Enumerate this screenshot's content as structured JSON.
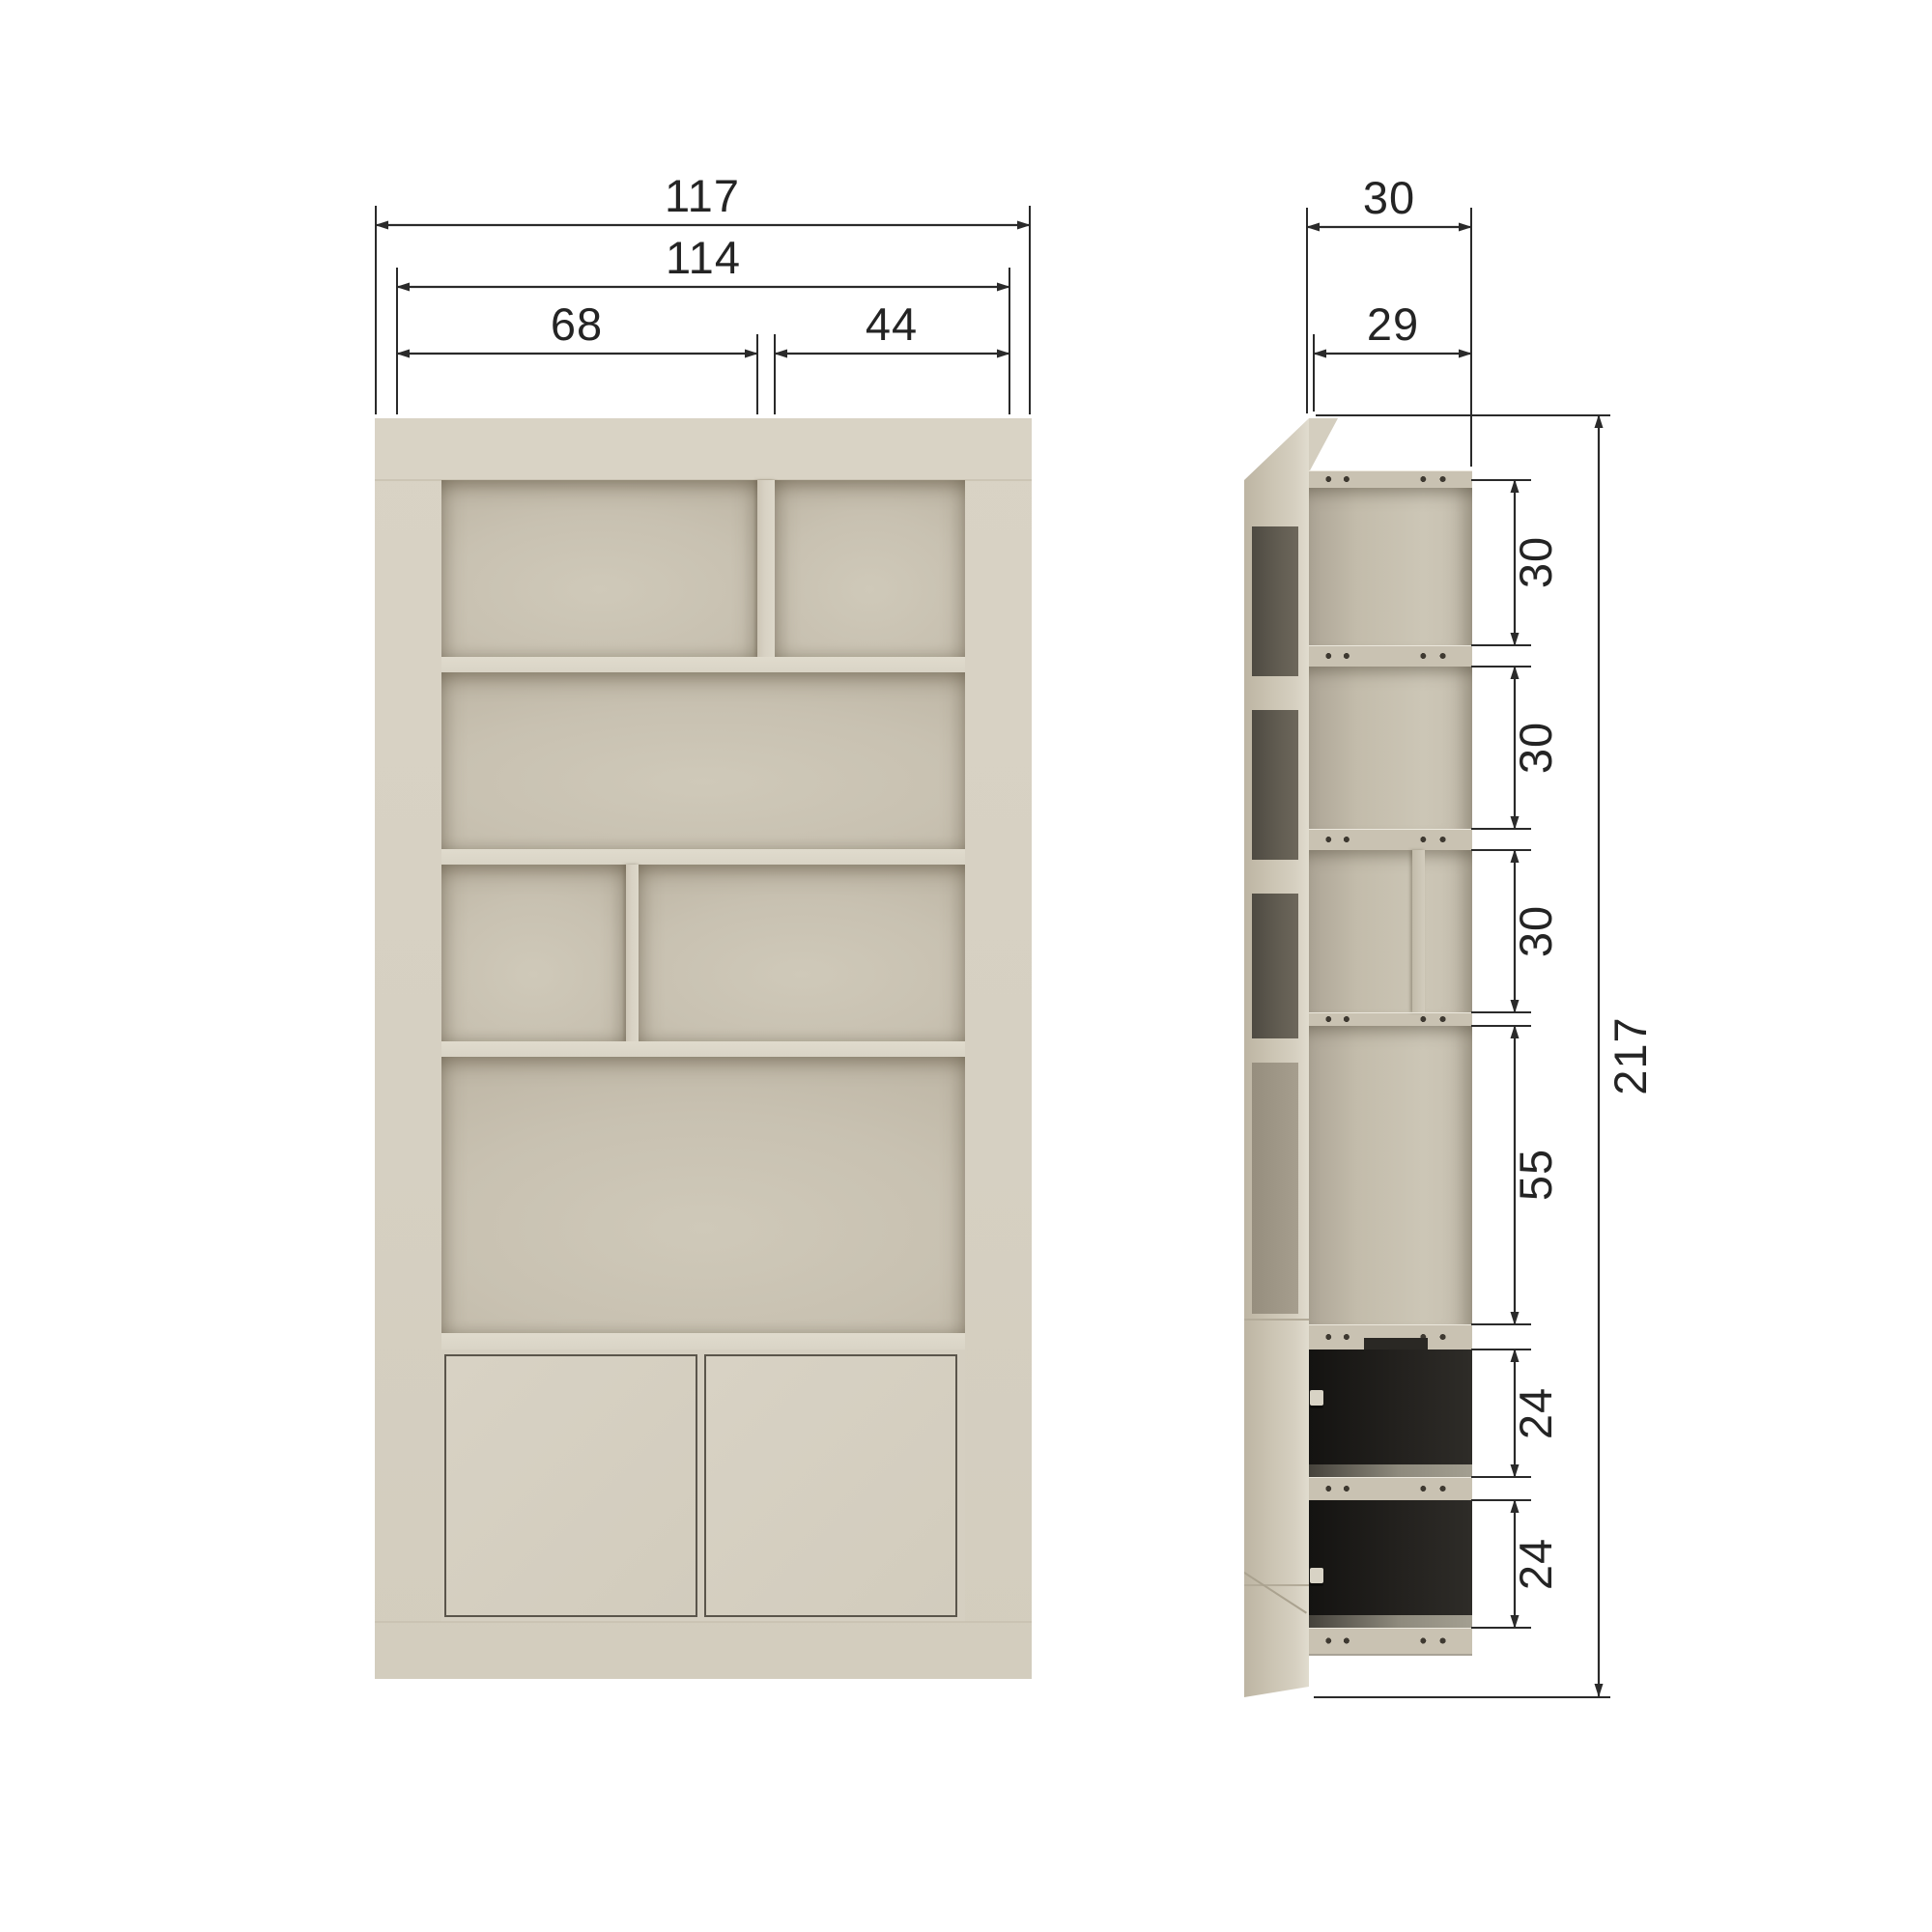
{
  "diagram": {
    "kind": "cabinet dimension drawing, front and side elevation",
    "views": {
      "front": {
        "dims": {
          "overall_width": "117",
          "inner_width": "114",
          "left_opening_width": "68",
          "right_opening_width": "44"
        }
      },
      "side": {
        "dims": {
          "overall_depth": "30",
          "inner_depth": "29",
          "overall_height": "217"
        },
        "compartment_heights": [
          "30",
          "30",
          "30",
          "55",
          "24",
          "24"
        ]
      }
    },
    "palette": {
      "background": "#ffffff",
      "frame": "#d6d0c2",
      "shelf_edge": "#ddd8ca",
      "interior": "#c9c2b2",
      "interior_shadow": "#b0a897",
      "dark_compartment": "#23211e",
      "door_outline": "#5a554b",
      "dimension_line": "#2a2a2a",
      "dimension_text": "#242424"
    }
  }
}
